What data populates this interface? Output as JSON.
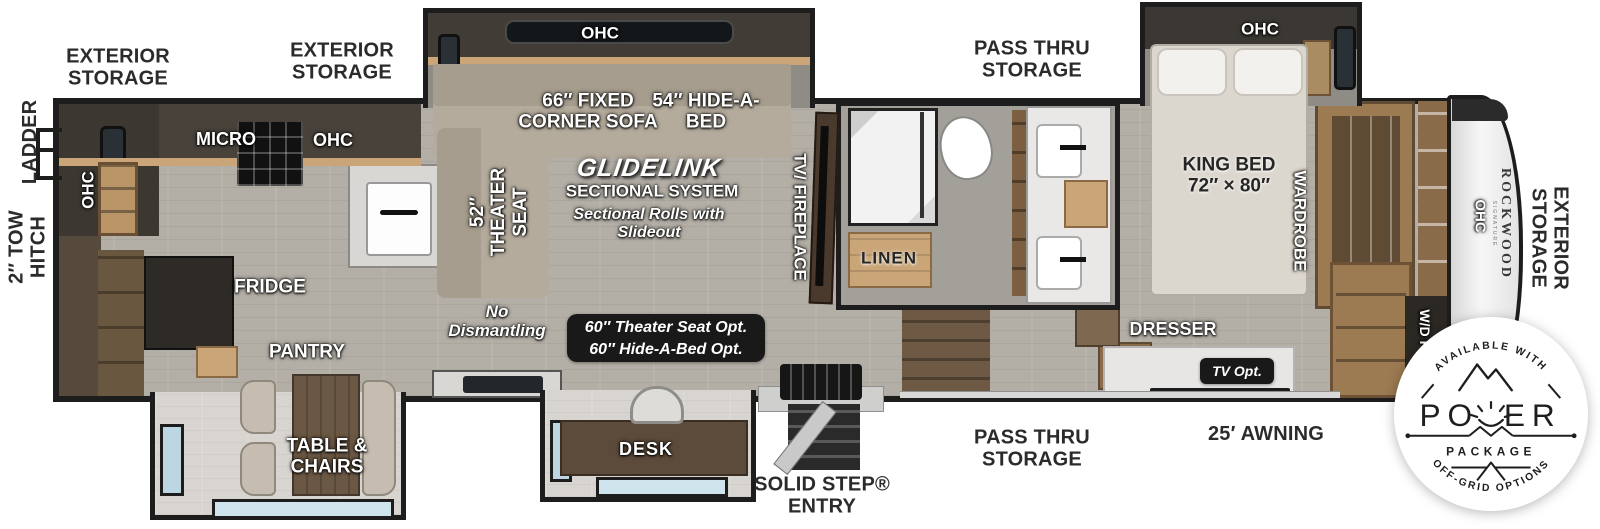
{
  "colors": {
    "wall": "#1d1d1d",
    "floor": "#b3afa6",
    "wood_light": "#c9a577",
    "wood_dark": "#8a6b49",
    "sofa": "#b4ab9c",
    "label_dark": "#2b2b2b",
    "option_box": "#191919"
  },
  "exterior": {
    "storage_rear": [
      "EXTERIOR",
      "STORAGE"
    ],
    "storage_mid": [
      "EXTERIOR",
      "STORAGE"
    ],
    "pass_thru_top": [
      "PASS THRU",
      "STORAGE"
    ],
    "pass_thru_bottom": [
      "PASS THRU",
      "STORAGE"
    ],
    "ladder": "LADDER",
    "tow_hitch": [
      "2″ TOW",
      "HITCH"
    ],
    "awning": "25′ AWNING",
    "solid_step": [
      "SOLID STEP®",
      "ENTRY"
    ],
    "storage_front": [
      "EXTERIOR",
      "STORAGE"
    ]
  },
  "kitchen": {
    "ohc_left": "OHC",
    "micro": "MICRO",
    "ohc_top": "OHC",
    "fridge": "FRIDGE",
    "pantry": "PANTRY",
    "table_chairs": [
      "TABLE &",
      "CHAIRS"
    ],
    "desk": "DESK"
  },
  "living": {
    "ohc": "OHC",
    "corner_sofa": [
      "66″ FIXED",
      "CORNER SOFA"
    ],
    "hide_a_bed": [
      "54″ HIDE-A-",
      "BED"
    ],
    "glidelink": "GLIDELINK",
    "sectional_system": "SECTIONAL SYSTEM",
    "sectional_note": [
      "Sectional Rolls with",
      "Slideout"
    ],
    "theater_seat": [
      "52″",
      "THEATER",
      "SEAT"
    ],
    "no_dismantling": [
      "No",
      "Dismantling"
    ],
    "options": [
      "60″ Theater Seat Opt.",
      "60″ Hide-A-Bed Opt."
    ],
    "tv_fireplace": "TV/ FIREPLACE"
  },
  "bath": {
    "linen": "LINEN"
  },
  "bedroom": {
    "ohc": "OHC",
    "king_bed": [
      "KING BED",
      "72″ × 80″"
    ],
    "wardrobe": "WARDROBE",
    "dresser": "DRESSER",
    "tv_opt": "TV Opt.",
    "ohc_front": "OHC",
    "wd_prep": "W/D PREP"
  },
  "brand": {
    "name": "ROCKWOOD",
    "series": "SIGNATURE"
  },
  "badge": {
    "top": "AVAILABLE WITH",
    "power_left": "PO",
    "power_right": "ER",
    "package": "PACKAGE",
    "bottom": "OFF-GRID OPTIONS"
  }
}
